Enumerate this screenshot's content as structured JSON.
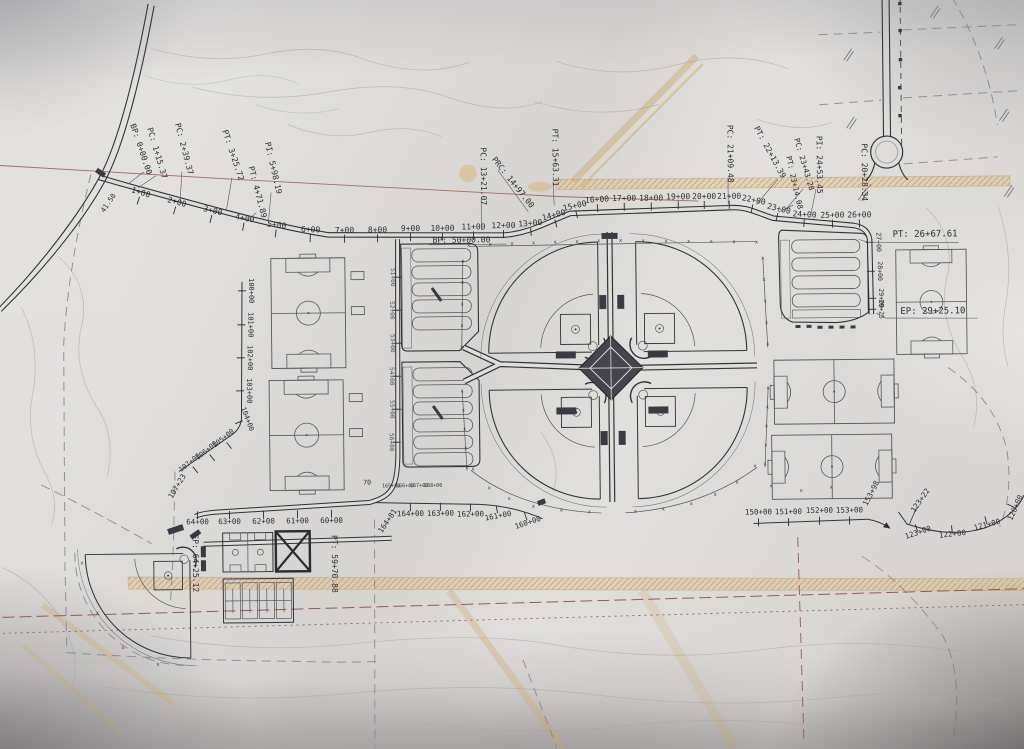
{
  "title": "Sports complex site plan (photographed engineering drawing)",
  "symbols": {
    "fence_mark": "x"
  },
  "main_road": {
    "bp_label": "BP: 0+00.00",
    "stations": [
      "1+00",
      "2+00",
      "3+00",
      "4+00",
      "5+00",
      "6+00",
      "7+00",
      "8+00",
      "9+00",
      "10+00",
      "11+00",
      "12+00",
      "13+00",
      "14+00",
      "15+00",
      "16+00",
      "17+00",
      "18+00",
      "19+00",
      "20+00",
      "21+00",
      "22+00",
      "23+00",
      "24+00",
      "25+00",
      "26+00"
    ],
    "east_stations": [
      "27+00",
      "28+00",
      "29+00",
      "29+25"
    ],
    "control_points": {
      "pc1": "PC: 1+15.37",
      "pc2": "PC: 2+39.37",
      "pt3": "PT: 3+25.72",
      "pt4": "PT: 4+71.89",
      "pi5": "PI: 5+98.19",
      "pc13": "PC: 13+21.07",
      "prc14": "PRC: 14+97.00",
      "pt15": "PT: 15+63.31",
      "pc21": "PC: 21+09.48",
      "pt22": "PT: 22+13.39",
      "pt23": "PT: 23+14.08",
      "pc23": "PC: 23+43.28",
      "pi24": "PI: 24+53.45",
      "pc20": "PC: 20+28.34",
      "pt26": "PT: 26+67.61",
      "ep29": "EP: 29+25.10"
    }
  },
  "west_road": {
    "bp_label": "BP: 50+00.00",
    "side_stations": [
      "51+00",
      "52+00",
      "53+00",
      "54+00",
      "55+00",
      "56+00"
    ],
    "bottom_stations": [
      "64+00",
      "63+00",
      "62+00",
      "61+00",
      "60+00"
    ],
    "pt_label": "PT: 59+70.88",
    "ep_label": "EP: 64+25.12"
  },
  "left_path": {
    "stations": [
      "100+00",
      "101+00",
      "102+00",
      "103+00",
      "104+00",
      "105+00",
      "106+00",
      "107+00"
    ],
    "end_label": "107+23"
  },
  "south_path": {
    "stations": [
      "164+00",
      "163+00",
      "162+00",
      "161+00",
      "160+00"
    ],
    "upper_stations": [
      "165+00",
      "166+00",
      "167+00",
      "168+00"
    ],
    "corner_text": "70",
    "end_label": "164+81"
  },
  "southeast_path": {
    "stations": [
      "150+00",
      "151+00",
      "152+00",
      "153+00"
    ],
    "end_label": "153+98"
  },
  "east_curve": {
    "stations": [
      "123+00",
      "122+00",
      "121+00",
      "120+00"
    ],
    "point_label": "123+22"
  },
  "annotations": {
    "dim_note": "41.50"
  }
}
